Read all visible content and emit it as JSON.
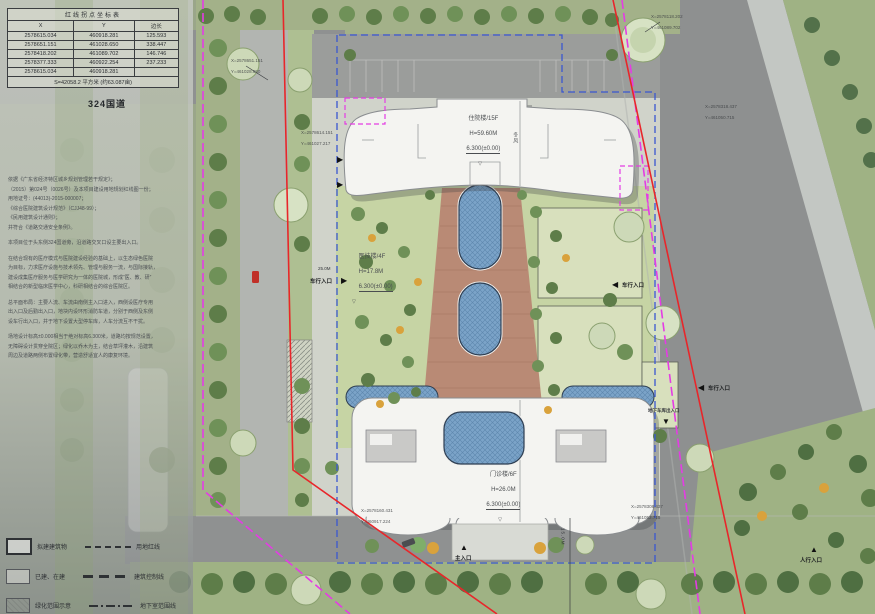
{
  "coord_table": {
    "title": "红线拐点坐标表",
    "col_x": "X",
    "col_y": "Y",
    "col_len": "边长",
    "rows": [
      {
        "x": "2578615.034",
        "y": "460918.281",
        "len": "125.593"
      },
      {
        "x": "2578651.151",
        "y": "461028.650",
        "len": "338.447"
      },
      {
        "x": "2578418.202",
        "y": "461089.702",
        "len": "146.746"
      },
      {
        "x": "2578377.333",
        "y": "460922.254",
        "len": "237.233"
      },
      {
        "x": "2578615.034",
        "y": "460918.281",
        "len": ""
      }
    ],
    "area": "S=42058.2 平方米 (约63.087亩)"
  },
  "road_label": "324国道",
  "notes": [
    "依据《广东省经济特区城乡规划管理若干规定》；",
    "（2015）第024号（0026号）及本项目建设用地规划红线图一份；",
    "用地证号：(44013)-2015-000007；",
    "《综合医院建筑设计规范》（CJJ48-99）；",
    "《民用建筑设计通则》；",
    "并符合《道路交通安全条例》。",
    "",
    "本项目位于头东侧324国道旁，沿道路交叉口设主要出入口。",
    "",
    "在结合现有的医疗模式与医院建设经验的基础上，以生态绿色医院",
    "为目标，力求医疗设施与技术领先、管理与服务一流，与国际接轨，",
    "建设成集医疗服务与医学研究为一体的医院城，形成“医、教、研”",
    "相结合的新型临床医学中心，科研相结合的综合医院区。",
    "",
    "总平面布局：主要人流、车流由南侧主入口进入，西侧设医疗专用",
    "出入口及后勤出入口，地块内设环形消防车道，分别于西侧及东侧",
    "设车行出入口，并于地下设置大型停车库，人车分流互不干扰。",
    "",
    "场地设计标高±0.000相当于绝对标高6.300米，道路均按规范设置，",
    "无障碍设计贯穿全院区；绿化以乔木为主，结合草坪灌木，沿建筑",
    "周边及道路两侧布置绿化带，营造舒适宜人的康复环境。"
  ],
  "buildings": {
    "inpatient": {
      "name": "住院楼/15F",
      "height": "H=59.60M",
      "elev": "6.300(±0.00)",
      "mark": "▽"
    },
    "medtech": {
      "name": "医技楼/4F",
      "height": "H=17.8M",
      "elev": "6.300(±0.00)",
      "mark": "▽"
    },
    "outpatient": {
      "name": "门诊楼/6F",
      "height": "H=26.0M",
      "elev": "6.300(±0.00)",
      "mark": "▽"
    }
  },
  "entrances": {
    "left_vehicle": "车行入口",
    "right_vehicle": "车行入口",
    "right_lower_vehicle": "车行入口",
    "garage": "地下车库出入口",
    "main": "主入口",
    "pedestrian": "人行入口"
  },
  "callouts": [
    {
      "l1": "X=2578651.151",
      "l2": "Y=461028.650"
    },
    {
      "l1": "X=2578614.151",
      "l2": "Y=461027.217"
    },
    {
      "l1": "X=2578118.202",
      "l2": "Y=461089.702"
    },
    {
      "l1": "X=2578318.437",
      "l2": "Y=461050.715"
    },
    {
      "l1": "X=2578160.431",
      "l2": "Y=460917.224"
    },
    {
      "l1": "X=2578308.437",
      "l2": "Y=461052.715"
    }
  ],
  "dims": {
    "left_road": "25.0M",
    "bottom_road": "15.0M"
  },
  "wind": "冬风",
  "legend": {
    "left": [
      {
        "label": "拟建建筑物"
      },
      {
        "label": "已建、在建"
      },
      {
        "label": "绿化范围示意"
      }
    ],
    "right": [
      {
        "label": "用地红线"
      },
      {
        "label": "建筑控制线"
      },
      {
        "label": "地下室范围线"
      }
    ]
  },
  "colors": {
    "red_line": "#e8262a",
    "boundary_magenta": "#e43ce4",
    "control_blue": "#3a57d0",
    "water": "#7ba3c8",
    "ramp": "#b98a75"
  }
}
